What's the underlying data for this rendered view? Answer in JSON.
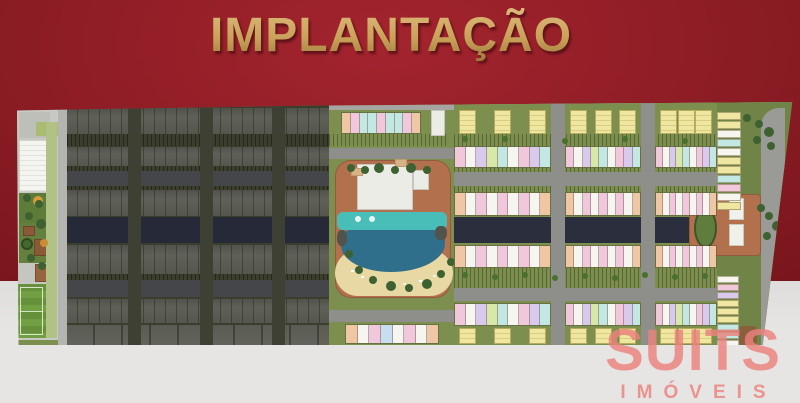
{
  "title": "IMPLANTAÇÃO",
  "watermark": {
    "name": "SUITS",
    "tagline": "IMÓVEIS"
  },
  "palette": {
    "bg_top": "#8B1C24",
    "bg_top_light": "#A3242E",
    "bg_top_dark": "#6D1217",
    "bg_bottom": "#E6E5E3",
    "title_gold": "#C9A159",
    "title_gold_light": "#DDB97A",
    "title_gold_dark": "#9A773C",
    "watermark_pink": "#EB827D",
    "plan_green": "#7D8F4E",
    "plan_green_dark": "#3B3E2D",
    "road_light": "#8E8E8A",
    "road_dark": "#45464A",
    "canal": "#262A38",
    "pool_teal": "#49BEB9",
    "pool_deep": "#306F8B",
    "sand": "#E8D8A3",
    "terracotta": "#B2704D",
    "field_green": "#67903B",
    "tree_green": "#3D6130",
    "unit_yellow": "#EFE7A1",
    "unit_white": "#F6F5F0",
    "unit_teal": "#C3E7E3",
    "unit_pink": "#F0C7DB",
    "unit_purple": "#D9C9EC",
    "unit_green": "#D8E8A9",
    "unit_orange": "#EFC7A4",
    "unit_sky": "#C7DEF0"
  },
  "plan": {
    "blocks": [
      {
        "x": 437,
        "w": 97
      },
      {
        "x": 548,
        "w": 76
      },
      {
        "x": 638,
        "w": 62
      }
    ],
    "bands": [
      {
        "y": 8,
        "h": 24,
        "type": "pairs"
      },
      {
        "y": 44,
        "h": 22,
        "type": "mixed"
      },
      {
        "y": 90,
        "h": 24,
        "type": "long"
      },
      {
        "y": 143,
        "h": 23,
        "type": "long"
      },
      {
        "y": 201,
        "h": 23,
        "type": "mixed"
      },
      {
        "y": 226,
        "h": 16,
        "type": "pairs"
      }
    ],
    "mixed_seq": [
      "pink",
      "white",
      "purple",
      "green",
      "teal",
      "white",
      "pink",
      "purple",
      "teal"
    ],
    "long_seq": [
      "orange",
      "white",
      "pink",
      "white",
      "pink",
      "white",
      "pink",
      "white",
      "orange"
    ],
    "center_top_seq": [
      "orange",
      "pink",
      "teal",
      "teal",
      "pink",
      "teal",
      "teal",
      "pink",
      "orange"
    ],
    "center_bottom_seq": [
      "orange",
      "white",
      "pink",
      "sky",
      "white",
      "pink",
      "white",
      "orange"
    ],
    "stack_top_seq": [
      "yellow",
      "yellow",
      "white",
      "teal",
      "white",
      "yellow",
      "yellow",
      "teal",
      "pink",
      "white",
      "yellow"
    ],
    "stack_bottom_seq": [
      "white",
      "pink",
      "purple",
      "yellow",
      "yellow",
      "yellow",
      "teal",
      "teal",
      "white",
      "orange"
    ]
  }
}
